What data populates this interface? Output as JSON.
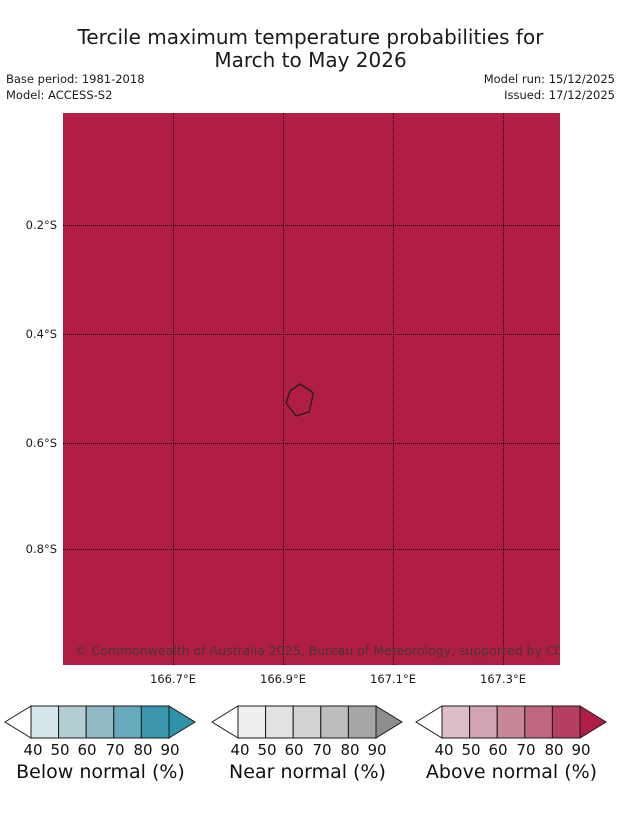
{
  "title": {
    "line1": "Tercile maximum temperature probabilities for",
    "line2": "March to May 2026"
  },
  "meta": {
    "base_period": "Base period: 1981-2018",
    "model": "Model: ACCESS-S2",
    "model_run": "Model run: 15/12/2025",
    "issued": "Issued: 17/12/2025"
  },
  "map": {
    "fill": "#b01d45",
    "copyright": "© Commonwealth of Australia 2025, Bureau of Meteorology, supported by COSPPac",
    "y_ticks": [
      "0.2°S",
      "0.4°S",
      "0.6°S",
      "0.8°S"
    ],
    "x_ticks": [
      "166.7°E",
      "166.9°E",
      "167.1°E",
      "167.3°E"
    ],
    "island_outline_points": "237,271 250.5,280 246,299 233,303 223,290 227,278"
  },
  "legends": [
    {
      "label": "Below normal (%)",
      "ticks": [
        "40",
        "50",
        "60",
        "70",
        "80",
        "90"
      ],
      "colors": [
        "#d5e6ea",
        "#b2cdd4",
        "#8fbac6",
        "#66aabb",
        "#3b97ad"
      ],
      "arrow_color": "#2e93a9"
    },
    {
      "label": "Near normal (%)",
      "ticks": [
        "40",
        "50",
        "60",
        "70",
        "80",
        "90"
      ],
      "colors": [
        "#efefef",
        "#e2e2e2",
        "#d3d3d3",
        "#bdbdbd",
        "#a6a6a6"
      ],
      "arrow_color": "#8d8d8d"
    },
    {
      "label": "Above normal (%)",
      "ticks": [
        "40",
        "50",
        "60",
        "70",
        "80",
        "90"
      ],
      "colors": [
        "#ddbec8",
        "#d2a3b1",
        "#c98699",
        "#c06780",
        "#b43f61"
      ],
      "arrow_color": "#b01d45"
    }
  ],
  "chart_data": {
    "type": "heatmap",
    "title": "Tercile maximum temperature probabilities for March to May 2026",
    "x_tick_labels": [
      "166.7°E",
      "166.9°E",
      "167.1°E",
      "167.3°E"
    ],
    "y_tick_labels": [
      "0.2°S",
      "0.4°S",
      "0.6°S",
      "0.8°S"
    ],
    "map_value": "Above normal probability >90% (uniform dark crimson fill) across the entire displayed region, with one small island coastline outlined near 166.93°E, 0.52°S",
    "legend_scales": [
      {
        "name": "Below normal (%)",
        "tick_range": [
          40,
          90
        ],
        "tick_step": 10
      },
      {
        "name": "Near normal (%)",
        "tick_range": [
          40,
          90
        ],
        "tick_step": 10
      },
      {
        "name": "Above normal (%)",
        "tick_range": [
          40,
          90
        ],
        "tick_step": 10
      }
    ],
    "layout_hints": {
      "grid": "dotted black lat/lon gridlines",
      "legend_position": "bottom, three horizontal arrow colorbars"
    }
  }
}
